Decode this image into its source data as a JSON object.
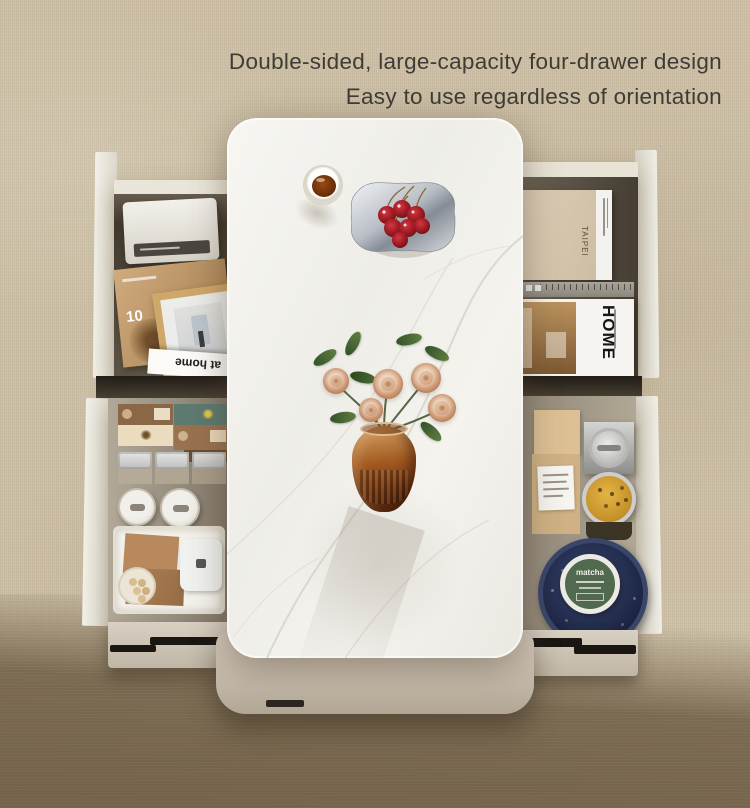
{
  "headline": {
    "line1": "Double-sided, large-capacity four-drawer design",
    "line2": "Easy to use regardless of orientation"
  },
  "labels": {
    "magazine_flip": "at home",
    "magazine_number": "10",
    "home_magazine": "HOME",
    "book_spine": "TAIPEI",
    "matcha_tin": "matcha"
  },
  "palette": {
    "carpet_light": "#cdc0a6",
    "carpet_dark": "#7b6a52",
    "headline_text": "#3f3b35",
    "marble_top": "#f4f3ef",
    "table_base": "#c9beb0",
    "drawer_face": "#efece2",
    "cherry_red": "#a31b23",
    "vase_amber": "#8a4a1c",
    "rose_pink": "#eccab0",
    "leaf_green": "#4a6b35",
    "matcha_green": "#51694e",
    "navy_plate": "#232c4e"
  },
  "scene": {
    "tabletop_items": [
      "glass-of-tea",
      "silver-dish-with-cherries",
      "amber-vase-with-roses"
    ],
    "drawer_top_left_items": [
      "white-radio",
      "floral-magazine",
      "wood-photo-frame",
      "at-home-magazine"
    ],
    "drawer_top_right_items": [
      "beige-book",
      "ruler",
      "home-magazine"
    ],
    "drawer_bottom_left_items": [
      "tea-boxes",
      "lidded-jars",
      "round-canisters",
      "storage-tray",
      "kraft-boxes",
      "snack-plate",
      "white-box"
    ],
    "drawer_bottom_right_items": [
      "kraft-boxes",
      "metal-canister",
      "honey-jar",
      "navy-plate",
      "matcha-tin"
    ]
  }
}
